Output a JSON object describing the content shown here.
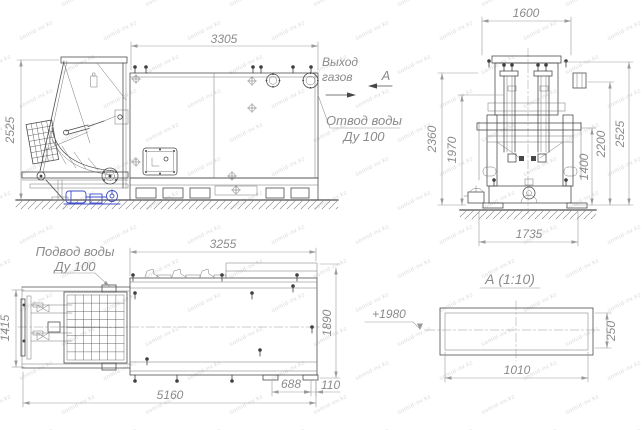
{
  "watermark": {
    "text": "somid-nv.kz"
  },
  "palette": {
    "line_color": "#4e4e4e",
    "dim_color": "#9a9a9a",
    "note_color": "#8b8b8b",
    "pump_blue": "#3f4ec8",
    "watermark_color": "#dadada"
  },
  "side_view": {
    "dim_width": "3305",
    "dim_height": "2525",
    "gas_outlet_line1": "Выход",
    "gas_outlet_line2": "газов",
    "section_mark": "А",
    "water_outlet_line1": "Отвод воды",
    "water_outlet_line2": "Ду 100"
  },
  "front_view": {
    "dim_top_width": "1600",
    "dim_left_outer": "2360",
    "dim_left_inner": "1970",
    "dim_right_inner": "1400",
    "dim_right_mid": "2200",
    "dim_right_outer": "2525",
    "dim_bottom_width": "1735"
  },
  "plan_view": {
    "water_inlet_line1": "Подвод воды",
    "water_inlet_line2": "Ду 100",
    "dim_top_width": "3255",
    "dim_right_height": "1890",
    "dim_left_height": "1415",
    "dim_bottom_width": "5160",
    "dim_foot_spacing": "688",
    "dim_foot_offset": "110"
  },
  "section_view": {
    "title": "А (1:10)",
    "elevation_mark": "+1980",
    "dim_width": "1010",
    "dim_height": "250"
  }
}
